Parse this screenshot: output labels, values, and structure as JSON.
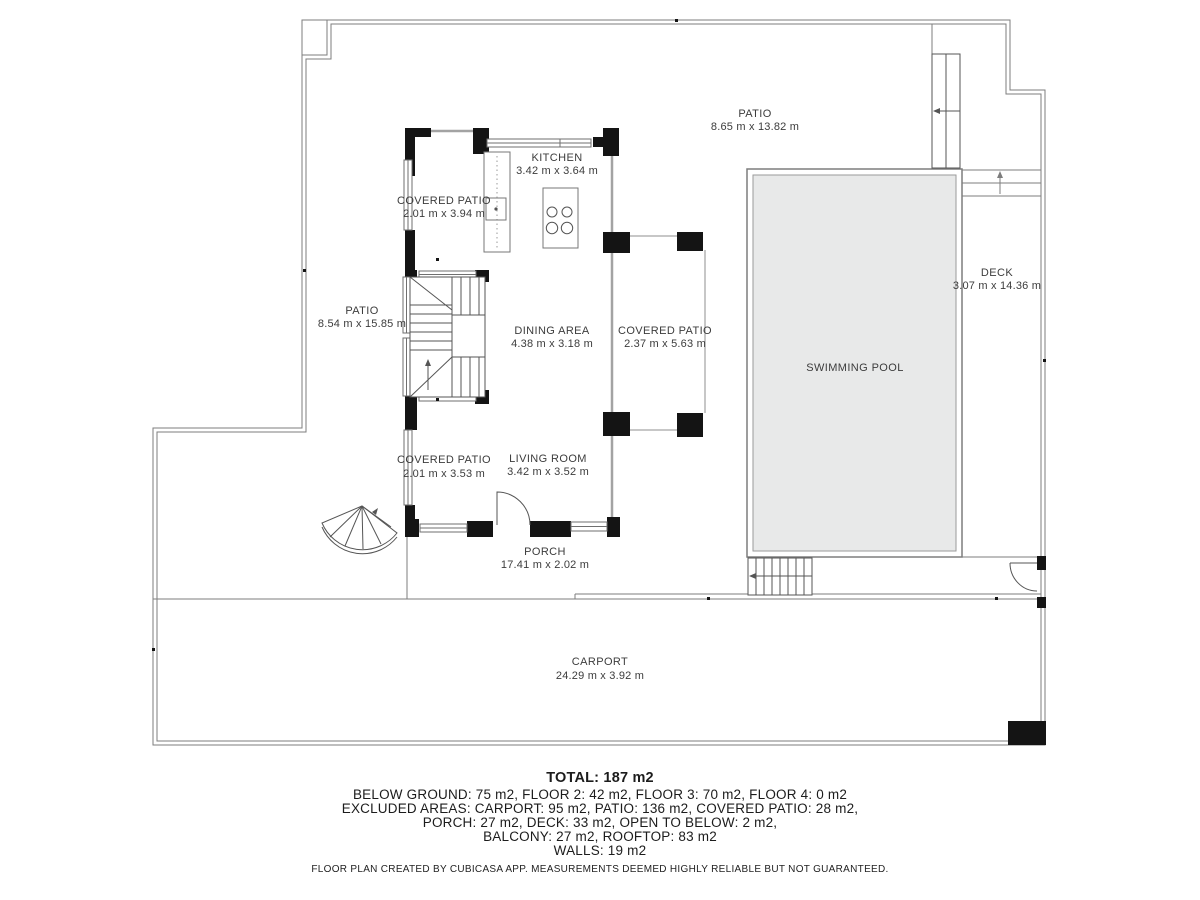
{
  "rooms": {
    "patio_top": {
      "name": "PATIO",
      "dims": "8.65 m x 13.82 m"
    },
    "kitchen": {
      "name": "KITCHEN",
      "dims": "3.42 m x 3.64 m"
    },
    "covered_patio_top": {
      "name": "COVERED PATIO",
      "dims": "2.01 m x 3.94 m"
    },
    "patio_left": {
      "name": "PATIO",
      "dims": "8.54 m x 15.85 m"
    },
    "dining_area": {
      "name": "DINING AREA",
      "dims": "4.38 m x 3.18 m"
    },
    "covered_patio_right": {
      "name": "COVERED PATIO",
      "dims": "2.37 m x 5.63 m"
    },
    "swimming_pool": {
      "name": "SWIMMING POOL"
    },
    "deck": {
      "name": "DECK",
      "dims": "3.07 m x 14.36 m"
    },
    "covered_patio_bottom": {
      "name": "COVERED PATIO",
      "dims": "2.01 m x 3.53 m"
    },
    "living_room": {
      "name": "LIVING ROOM",
      "dims": "3.42 m x 3.52 m"
    },
    "porch": {
      "name": "PORCH",
      "dims": "17.41 m x 2.02 m"
    },
    "carport": {
      "name": "CARPORT",
      "dims": "24.29 m x 3.92 m"
    }
  },
  "summary": {
    "total": "TOTAL: 187 m2",
    "floors": "BELOW GROUND: 75 m2, FLOOR 2: 42 m2, FLOOR 3: 70 m2, FLOOR 4: 0 m2",
    "excluded1": "EXCLUDED AREAS: CARPORT: 95 m2, PATIO: 136 m2, COVERED PATIO: 28 m2,",
    "excluded2": "PORCH: 27 m2, DECK: 33 m2, OPEN TO BELOW: 2 m2,",
    "excluded3": "BALCONY: 27 m2, ROOFTOP: 83 m2",
    "walls": "WALLS: 19 m2"
  },
  "disclaimer": "FLOOR PLAN CREATED BY CUBICASA APP. MEASUREMENTS DEEMED HIGHLY RELIABLE BUT NOT GUARANTEED.",
  "colors": {
    "wall": "#141414",
    "outline": "#7d7d7d",
    "thin_wall": "#a3a3a3",
    "pool_fill": "#e8e9e9",
    "label_text": "#3c3c3c"
  }
}
